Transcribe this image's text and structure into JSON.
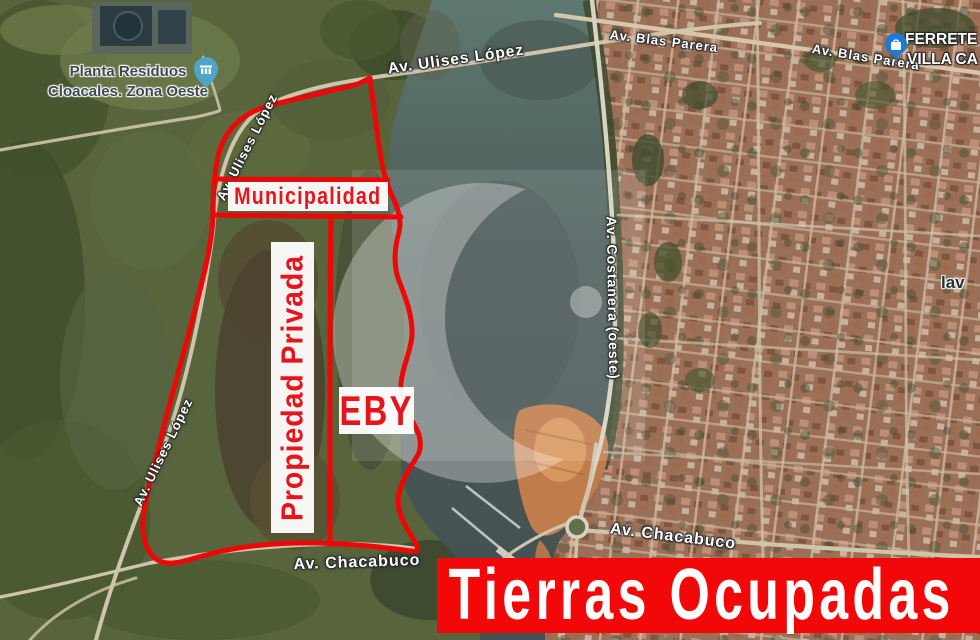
{
  "annotations": {
    "municipalidad": "Municipalidad",
    "propiedad_privada": "Propiedad Privada",
    "eby": "EBY",
    "banner": "Tierras Ocupadas"
  },
  "pois": {
    "planta_line1": "Planta Residuos",
    "planta_line2": "Cloacales. Zona Oeste",
    "ferreteria_line1": "FERRETE",
    "ferreteria_line2": "VILLA CA",
    "lavadero_partial": "lav"
  },
  "streets": {
    "ulises_top": "Av. Ulises López",
    "ulises_mid": "Av. Ulises López",
    "ulises_low": "Av. Ulises López",
    "blas_parera_1": "Av. Blas Parera",
    "blas_parera_2": "Av. Blas Parera",
    "costanera": "Av. Costanera (oeste)",
    "chacabuco_left": "Av. Chacabuco",
    "chacabuco_right": "Av. Chacabuco"
  },
  "colors": {
    "boundary_red": "#ee0707",
    "banner_red": "#f20808",
    "label_red": "#e8141b",
    "pin_teardrop_blue": "#4fa5c8",
    "pin_circle_blue": "#1d7ad6"
  }
}
